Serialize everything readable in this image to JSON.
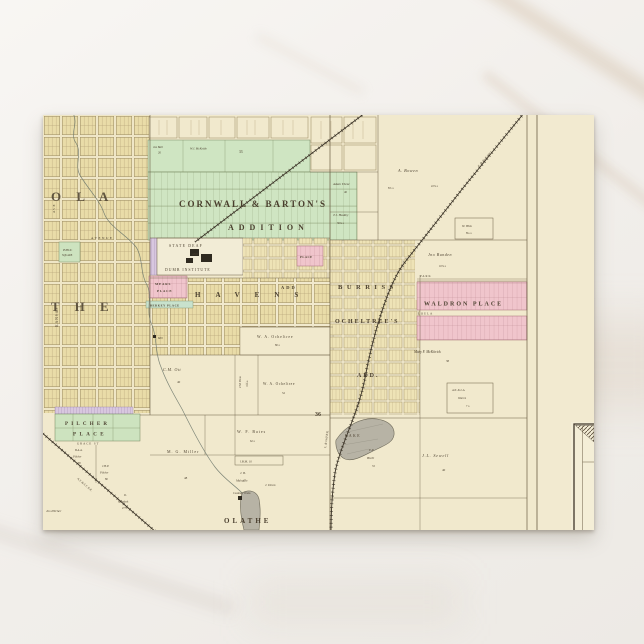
{
  "map": {
    "city_letters": {
      "row1": "O L A",
      "row2": "T H E"
    },
    "additions": {
      "cornwall_line1": "CORNWALL & BARTON'S",
      "cornwall_line2": "ADDITION",
      "institute_line1": "STATE DEAF",
      "institute_line2": "AND",
      "institute_line3": "DUMB INSTITUTE",
      "havens": "HAVENS",
      "havens_add": "ADD",
      "burriss": "BURRISS",
      "place_block": "PLACE",
      "mears_line1": "MEARS",
      "mears_line2": "PLACE",
      "berkey": "BERKEY PLACE",
      "waldron": "WALDRON PLACE",
      "ocheltree_line1": "OCHELTREE'S",
      "ocheltree_line2": "ADD.",
      "pilcher_line1": "PILCHER",
      "pilcher_line2": "PLACE",
      "public_line1": "PUBLIC",
      "public_line2": "SQUARE"
    },
    "streets": {
      "park": "PARK",
      "loula": "LOULA",
      "grace": "GRACE ST",
      "kansas": "KANSAS",
      "ave": "AVE",
      "avenue": "AVENUE"
    },
    "labels": {
      "olathe": "OLATHE",
      "lake": "LAKE",
      "mill": "Mill",
      "section36": "36",
      "creamery": "Creamery Works",
      "jbm": "J.B.M. 10"
    },
    "railroads": {
      "gulf": "L. & Gulf R.R.",
      "santafe": "A.T. & S.F. R.R."
    },
    "parcels": {
      "jas_ball": {
        "name": "Jas Ball",
        "acres": "20"
      },
      "mckettle": {
        "name": "W.J. McKettle",
        "acres": "33"
      },
      "bowen": {
        "name": "A. Bowen",
        "a1": "8⅞ a",
        "a2": "22⅞ a"
      },
      "thesz": {
        "name": "Adam Thesz",
        "acres": "40"
      },
      "hadley": {
        "name": "T.J. Hadley",
        "acres": "36¼ a"
      },
      "hisk": {
        "name": "W. Hisk",
        "acres": "8¼ a"
      },
      "bunden": {
        "name": "Jno Bunden",
        "acres": "10⅞ a"
      },
      "mckitrick": {
        "name": "Mary F. McKitrick",
        "acres": "38"
      },
      "warren": {
        "line1": "A.N. & L.A.",
        "line2": "Warren",
        "acres": "7 a"
      },
      "sewell": {
        "name": "J.L. Sewell",
        "acres": "40"
      },
      "bichl": {
        "line1": "E.P.",
        "line2": "Bichl",
        "acres": "33"
      },
      "ott": {
        "name": "C.M. Ott",
        "acres": "40"
      },
      "dow": {
        "name": "J.M. Dow",
        "acres": "10¾ a"
      },
      "och80": {
        "name": "W. A. Ocheltree",
        "acres": "80 a"
      },
      "och52": {
        "name": "W. A. Ocheltree",
        "acres": "52"
      },
      "bates": {
        "name": "W. F. Bates",
        "acres": "62 a"
      },
      "miller": {
        "name": "M. G. Miller",
        "acres": "48"
      },
      "mahaffie": {
        "line1": "J. B.",
        "line2": "Mahaffie"
      },
      "drum": {
        "name": "J. Drum"
      },
      "murdock": {
        "line1": "D.",
        "line2": "Murdock",
        "acres": "27½ a"
      },
      "pilcher_baa": {
        "line1": "B.A.A.",
        "line2": "Pilcher",
        "acres": "20"
      },
      "pilcher_jhp": {
        "line1": "J.H.P.",
        "line2": "Pilcher",
        "acres": "80"
      },
      "pilcher_jos": {
        "name": "Jos Pilcher"
      }
    }
  }
}
